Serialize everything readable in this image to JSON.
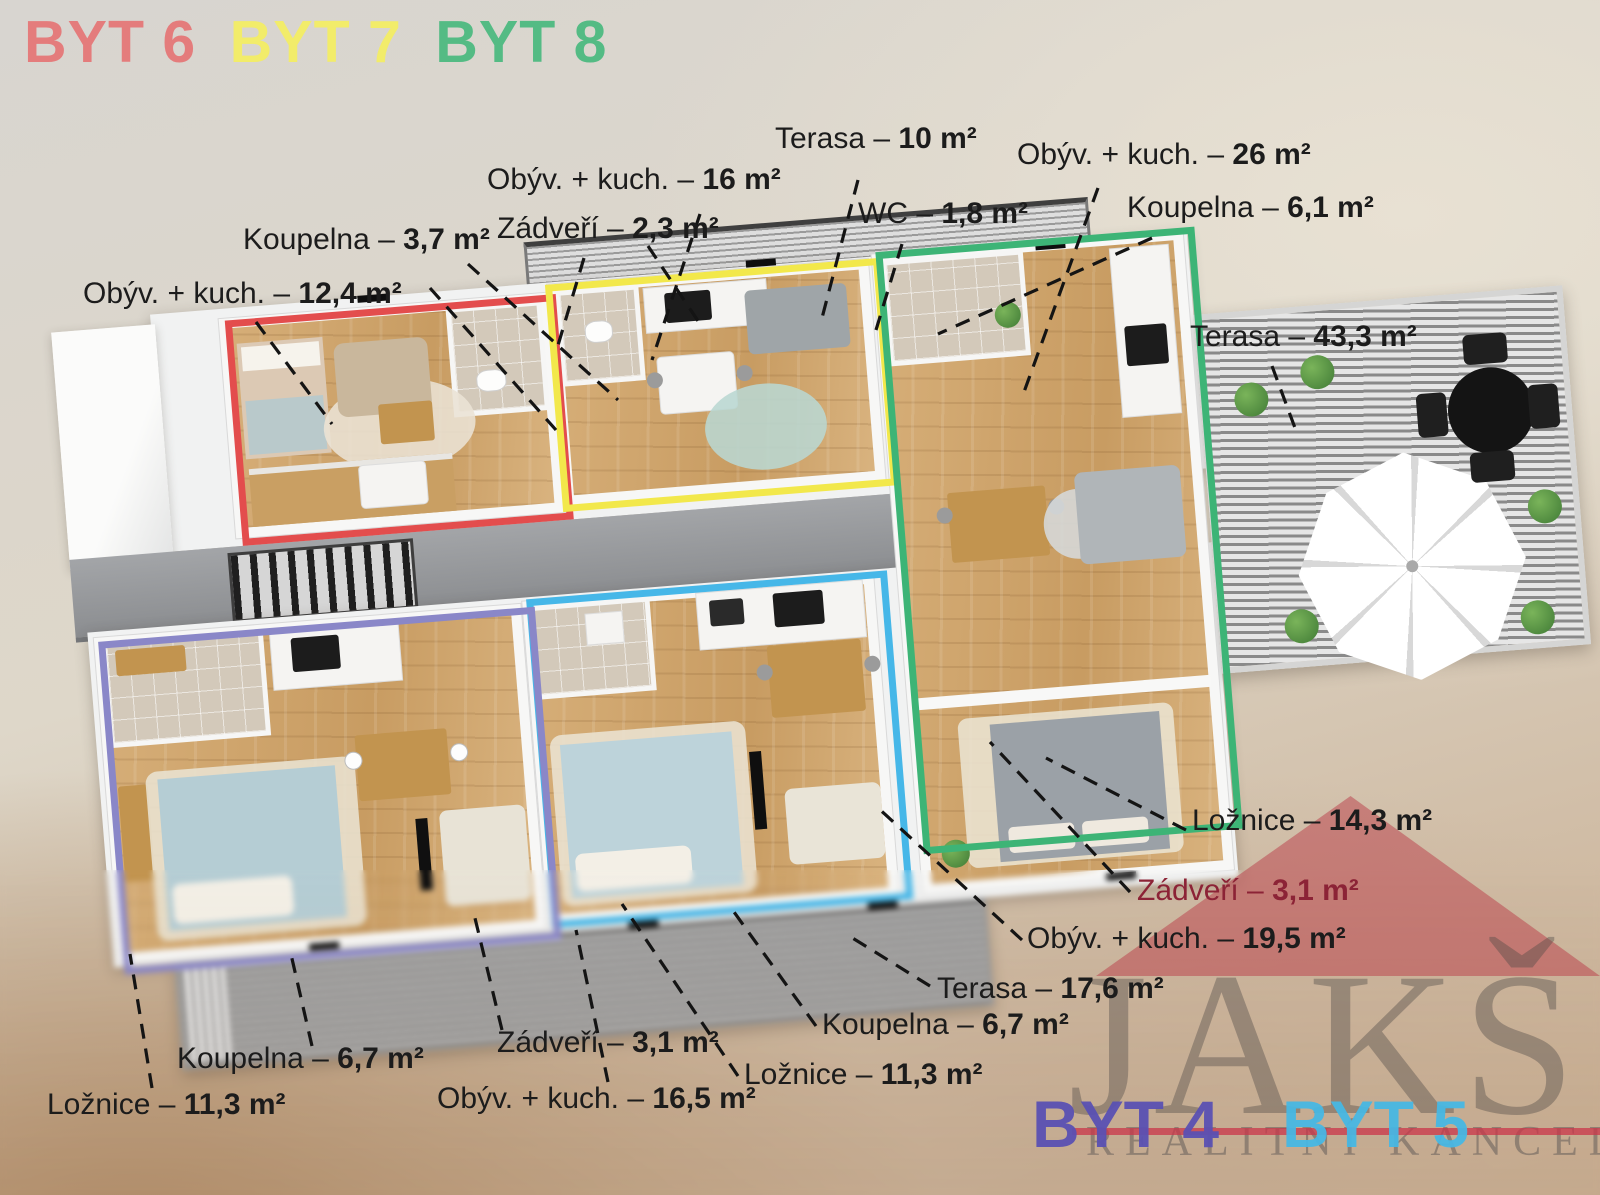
{
  "header": {
    "apartments_top": [
      {
        "label": "BYT 6",
        "color": "#e47c7c"
      },
      {
        "label": "BYT 7",
        "color": "#f2ec6a"
      },
      {
        "label": "BYT 8",
        "color": "#54bb84"
      }
    ]
  },
  "room_labels": [
    {
      "room": "Terasa – ",
      "area": "10 m²",
      "color": "#1c1c1c"
    },
    {
      "room": "Obýv. + kuch. – ",
      "area": "16 m²",
      "color": "#1c1c1c"
    },
    {
      "room": "Zádveří – ",
      "area": "2,3 m²",
      "color": "#1c1c1c"
    },
    {
      "room": "WC – ",
      "area": "1,8 m²",
      "color": "#1c1c1c"
    },
    {
      "room": "Obýv. + kuch. – ",
      "area": "26 m²",
      "color": "#1c1c1c"
    },
    {
      "room": "Koupelna – ",
      "area": "6,1 m²",
      "color": "#1c1c1c"
    },
    {
      "room": "Koupelna – ",
      "area": "3,7 m²",
      "color": "#1c1c1c"
    },
    {
      "room": "Obýv. + kuch. – ",
      "area": "12,4 m²",
      "color": "#1c1c1c"
    },
    {
      "room": "Terasa – ",
      "area": "43,3 m²",
      "color": "#1c1c1c"
    },
    {
      "room": "Ložnice – ",
      "area": "14,3 m²",
      "color": "#1c1c1c"
    },
    {
      "room": "Zádveří – ",
      "area": "3,1 m²",
      "color": "#8c2336"
    },
    {
      "room": "Obýv. + kuch. – ",
      "area": "19,5 m²",
      "color": "#1c1c1c"
    },
    {
      "room": "Terasa – ",
      "area": "17,6 m²",
      "color": "#1c1c1c"
    },
    {
      "room": "Koupelna – ",
      "area": "6,7 m²",
      "color": "#1c1c1c"
    },
    {
      "room": "Ložnice – ",
      "area": "11,3 m²",
      "color": "#1c1c1c"
    },
    {
      "room": "Zádveří – ",
      "area": "3,1 m²",
      "color": "#1c1c1c"
    },
    {
      "room": "Obýv. + kuch. – ",
      "area": "16,5 m²",
      "color": "#1c1c1c"
    },
    {
      "room": "Koupelna – ",
      "area": "6,7 m²",
      "color": "#1c1c1c"
    },
    {
      "room": "Ložnice – ",
      "area": "11,3 m²",
      "color": "#1c1c1c"
    }
  ],
  "watermark": {
    "brand": "JAKŠ",
    "subtitle": "REALITNÍ KANCELÁŘ",
    "accent_color": "#c9364a",
    "brand_color": "#4d4846"
  },
  "footer_apartments": [
    {
      "label": "BYT 4",
      "color": "#584fb4"
    },
    {
      "label": "BYT 5",
      "color": "#44b8e6"
    }
  ],
  "plan_colors": {
    "byt6_outline": "#e34d4d",
    "byt7_outline": "#f2e84b",
    "byt8_outline": "#3db476",
    "byt5_outline": "#46b7e8",
    "byt4_outline": "#8a87c8",
    "roof": "#919396",
    "wood_floor": "#cfa26c",
    "bath_tile": "#d3c9ba"
  }
}
